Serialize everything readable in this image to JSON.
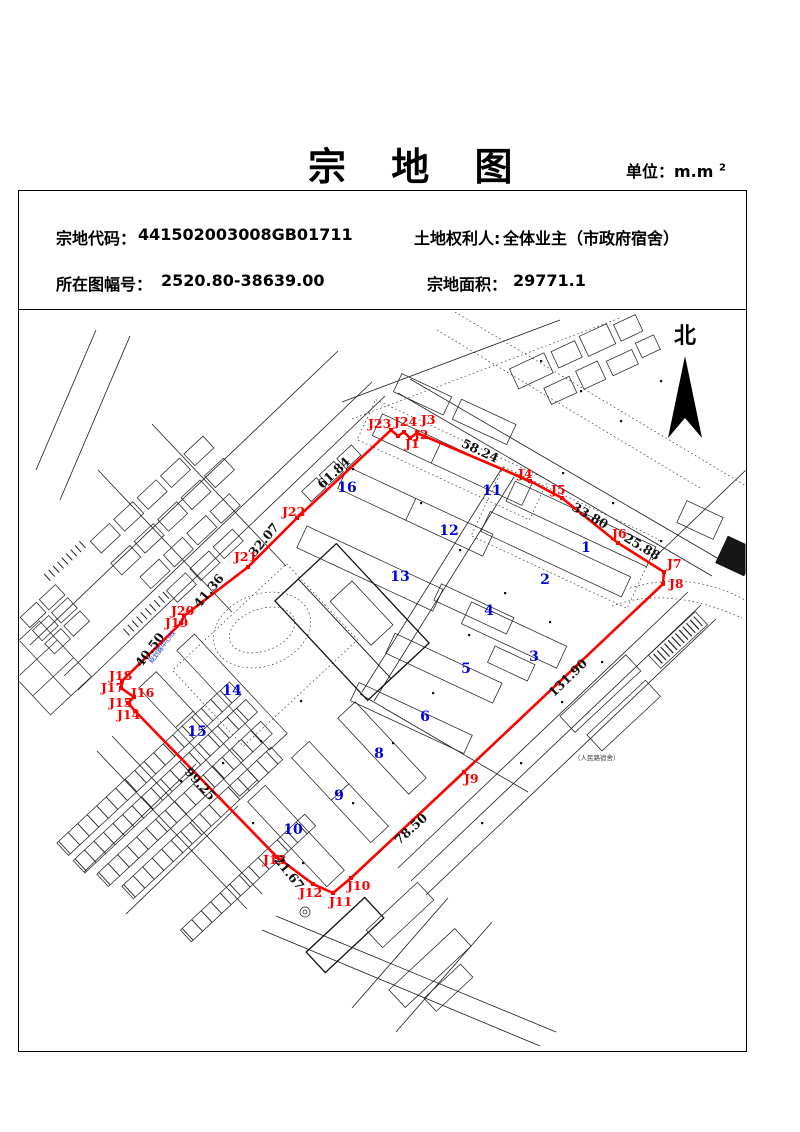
{
  "page": {
    "title": "宗 地 图",
    "unit_prefix": "单位：m.m",
    "unit_sup": "2"
  },
  "info": {
    "code_label": "宗地代码：",
    "code_value": "441502003008GB01711",
    "holder_label": "土地权利人:",
    "holder_value": "全体业主（市政府宿舍）",
    "sheet_label": "所在图幅号：",
    "sheet_value": "2520.80-38639.00",
    "area_label": "宗地面积：",
    "area_value": "29771.1"
  },
  "map": {
    "north_label": "北",
    "colors": {
      "boundary": "#ff0000",
      "numbers": "#0000dd",
      "distance": "#111111"
    },
    "vertices": [
      [
        391,
        430
      ],
      [
        398,
        436
      ],
      [
        404,
        432
      ],
      [
        410,
        438
      ],
      [
        417,
        433
      ],
      [
        530,
        481
      ],
      [
        562,
        498
      ],
      [
        618,
        543
      ],
      [
        664,
        572
      ],
      [
        663,
        584
      ],
      [
        464,
        772
      ],
      [
        351,
        878
      ],
      [
        333,
        893
      ],
      [
        313,
        884
      ],
      [
        277,
        857
      ],
      [
        135,
        711
      ],
      [
        128,
        703
      ],
      [
        134,
        697
      ],
      [
        121,
        688
      ],
      [
        122,
        681
      ],
      [
        181,
        623
      ],
      [
        184,
        616
      ],
      [
        248,
        567
      ],
      [
        297,
        518
      ]
    ],
    "point_labels": [
      {
        "t": "J1",
        "x": 405,
        "y": 448
      },
      {
        "t": "J2",
        "x": 414,
        "y": 439
      },
      {
        "t": "J3",
        "x": 421,
        "y": 424
      },
      {
        "t": "J4",
        "x": 518,
        "y": 478
      },
      {
        "t": "J5",
        "x": 551,
        "y": 494
      },
      {
        "t": "J6",
        "x": 612,
        "y": 538
      },
      {
        "t": "J7",
        "x": 667,
        "y": 568
      },
      {
        "t": "J8",
        "x": 669,
        "y": 588
      },
      {
        "t": "J9",
        "x": 464,
        "y": 783
      },
      {
        "t": "J10",
        "x": 347,
        "y": 890
      },
      {
        "t": "J11",
        "x": 329,
        "y": 906
      },
      {
        "t": "J12",
        "x": 299,
        "y": 897
      },
      {
        "t": "J13",
        "x": 263,
        "y": 864
      },
      {
        "t": "J14",
        "x": 117,
        "y": 719
      },
      {
        "t": "J15",
        "x": 109,
        "y": 707
      },
      {
        "t": "J16",
        "x": 131,
        "y": 697
      },
      {
        "t": "J17",
        "x": 101,
        "y": 692
      },
      {
        "t": "J18",
        "x": 109,
        "y": 680
      },
      {
        "t": "J19",
        "x": 165,
        "y": 627
      },
      {
        "t": "J20",
        "x": 171,
        "y": 615
      },
      {
        "t": "J21",
        "x": 234,
        "y": 561
      },
      {
        "t": "J22",
        "x": 282,
        "y": 516
      },
      {
        "t": "J23",
        "x": 368,
        "y": 428
      },
      {
        "t": "J24",
        "x": 394,
        "y": 426
      }
    ],
    "distance_labels": [
      {
        "t": "58.24",
        "x": 480,
        "y": 451,
        "r": 25
      },
      {
        "t": "33.80",
        "x": 590,
        "y": 516,
        "r": 30
      },
      {
        "t": "25.88",
        "x": 642,
        "y": 547,
        "r": 31
      },
      {
        "t": "131.90",
        "x": 568,
        "y": 678,
        "r": -44
      },
      {
        "t": "78.50",
        "x": 411,
        "y": 829,
        "r": -42
      },
      {
        "t": "21.67",
        "x": 289,
        "y": 873,
        "r": 51
      },
      {
        "t": "99.25",
        "x": 200,
        "y": 784,
        "r": 48
      },
      {
        "t": "40.50",
        "x": 150,
        "y": 650,
        "r": -53
      },
      {
        "t": "41.36",
        "x": 209,
        "y": 591,
        "r": -50
      },
      {
        "t": "32.07",
        "x": 264,
        "y": 540,
        "r": -50
      },
      {
        "t": "61.84",
        "x": 334,
        "y": 473,
        "r": -43
      }
    ],
    "building_numbers": [
      {
        "t": "1",
        "x": 586,
        "y": 547
      },
      {
        "t": "2",
        "x": 545,
        "y": 579
      },
      {
        "t": "3",
        "x": 534,
        "y": 656
      },
      {
        "t": "4",
        "x": 489,
        "y": 610
      },
      {
        "t": "5",
        "x": 466,
        "y": 668
      },
      {
        "t": "6",
        "x": 425,
        "y": 716
      },
      {
        "t": "8",
        "x": 379,
        "y": 753
      },
      {
        "t": "9",
        "x": 339,
        "y": 795
      },
      {
        "t": "10",
        "x": 293,
        "y": 829
      },
      {
        "t": "11",
        "x": 492,
        "y": 490
      },
      {
        "t": "12",
        "x": 449,
        "y": 530
      },
      {
        "t": "13",
        "x": 400,
        "y": 576
      },
      {
        "t": "14",
        "x": 232,
        "y": 690
      },
      {
        "t": "15",
        "x": 197,
        "y": 731
      },
      {
        "t": "16",
        "x": 347,
        "y": 487
      }
    ],
    "tiny_labels": [
      {
        "t": "（人民路宿舍）",
        "x": 574,
        "y": 760,
        "r": 0,
        "c": "#3a3a3a"
      },
      {
        "t": "规划路中心线",
        "x": 152,
        "y": 664,
        "r": -53,
        "c": "#2233bb"
      }
    ]
  }
}
